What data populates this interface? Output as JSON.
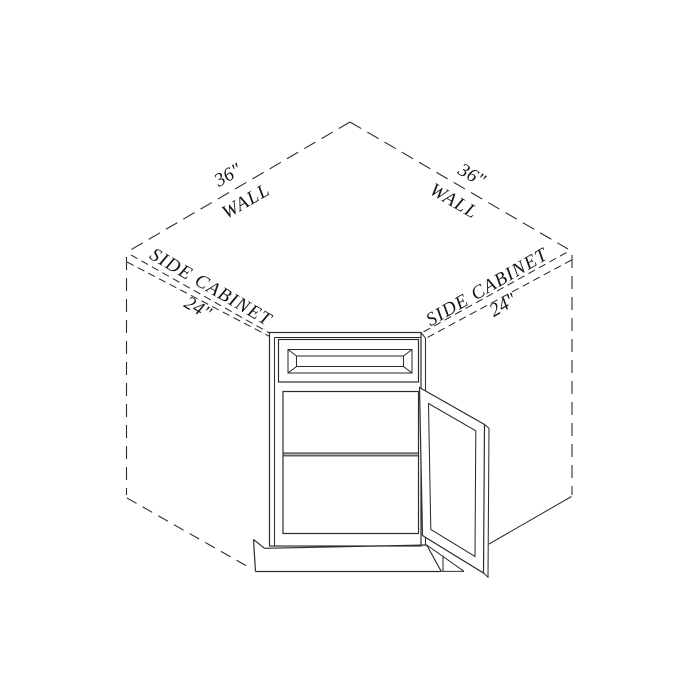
{
  "drawing": {
    "title": "Corner base cabinet with walls and side cabinets - isometric installation diagram",
    "type": "technical-line-drawing"
  },
  "labels": {
    "wall_left_dim": "36\"",
    "wall_left": "WALL",
    "wall_right_dim": "36\"",
    "wall_right": "WALL",
    "side_cabinet_left": "SIDE CABINET",
    "side_cabinet_left_dim": "24\"",
    "side_cabinet_right": "SIDE CABINET",
    "side_cabinet_right_dim": "24\""
  },
  "dimensions": {
    "wall_left_inches": 36,
    "wall_right_inches": 36,
    "side_cabinet_left_inches": 24,
    "side_cabinet_right_inches": 24
  },
  "colors": {
    "background": "#ffffff",
    "line": "#2e2e2e",
    "text": "#151515",
    "shelf_edge_fill": "#b3b3b3"
  }
}
